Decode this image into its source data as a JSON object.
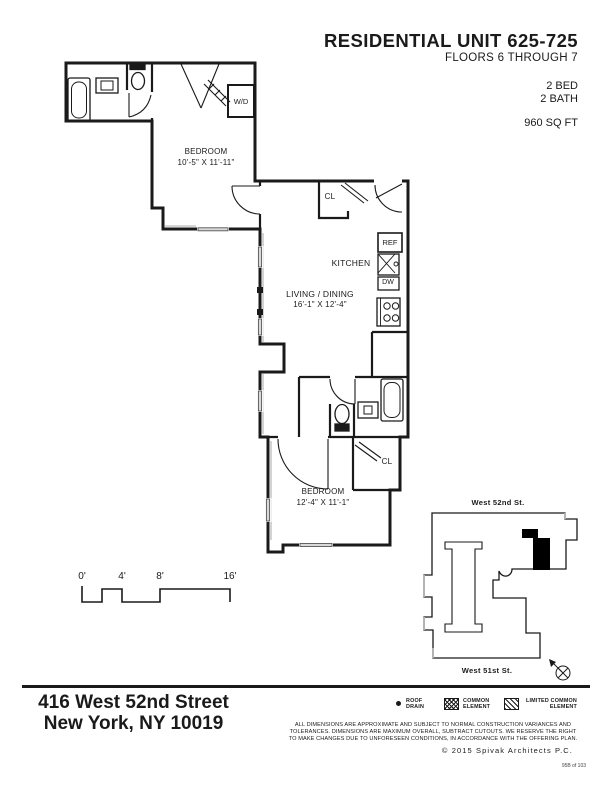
{
  "header": {
    "title": "RESIDENTIAL UNIT 625-725",
    "subtitle": "FLOORS 6 THROUGH 7",
    "bed": "2 BED",
    "bath": "2 BATH",
    "sqft": "960 SQ FT"
  },
  "plan": {
    "bedroom1": {
      "name": "BEDROOM",
      "dims": "10'-5\" X 11'-11\""
    },
    "living": {
      "name": "LIVING / DINING",
      "dims": "16'-1\" X 12'-4\""
    },
    "bedroom2": {
      "name": "BEDROOM",
      "dims": "12'-4\" X 11'-1\""
    },
    "kitchen_label": "KITCHEN",
    "closet1": "CL",
    "closet2": "CL",
    "washer_dryer": "W/D",
    "refrigerator": "REF",
    "dishwasher": "DW"
  },
  "scalebar": {
    "ticks": [
      "0'",
      "4'",
      "8'",
      "16'"
    ]
  },
  "keyplan": {
    "street_top": "West 52nd St.",
    "street_bottom": "West 51st St."
  },
  "footer": {
    "address_line1": "416 West 52nd Street",
    "address_line2": "New York, NY 10019",
    "legend": [
      {
        "line1": "ROOF",
        "line2": "DRAIN"
      },
      {
        "line1": "COMMON",
        "line2": "ELEMENT"
      },
      {
        "line1": "LIMITED COMMON",
        "line2": "ELEMENT"
      }
    ],
    "disclaimer_lines": [
      "ALL DIMENSIONS ARE APPROXIMATE AND SUBJECT TO NORMAL CONSTRUCTION VARIANCES AND",
      "TOLERANCES. DIMENSIONS ARE MAXIMUM OVERALL, SUBTRACT CUTOUTS. WE RESERVE THE RIGHT",
      "TO MAKE CHANGES DUE TO UNFORESEEN CONDITIONS, IN ACCORDANCE WITH THE OFFERING PLAN."
    ],
    "copyright": "©  2015 Spivak Architects P.C.",
    "page_number": "95B of 103"
  },
  "colors": {
    "ink": "#1a1a1a",
    "window_gray": "#d9d9d9",
    "accent_gray": "#b3b3b3"
  }
}
